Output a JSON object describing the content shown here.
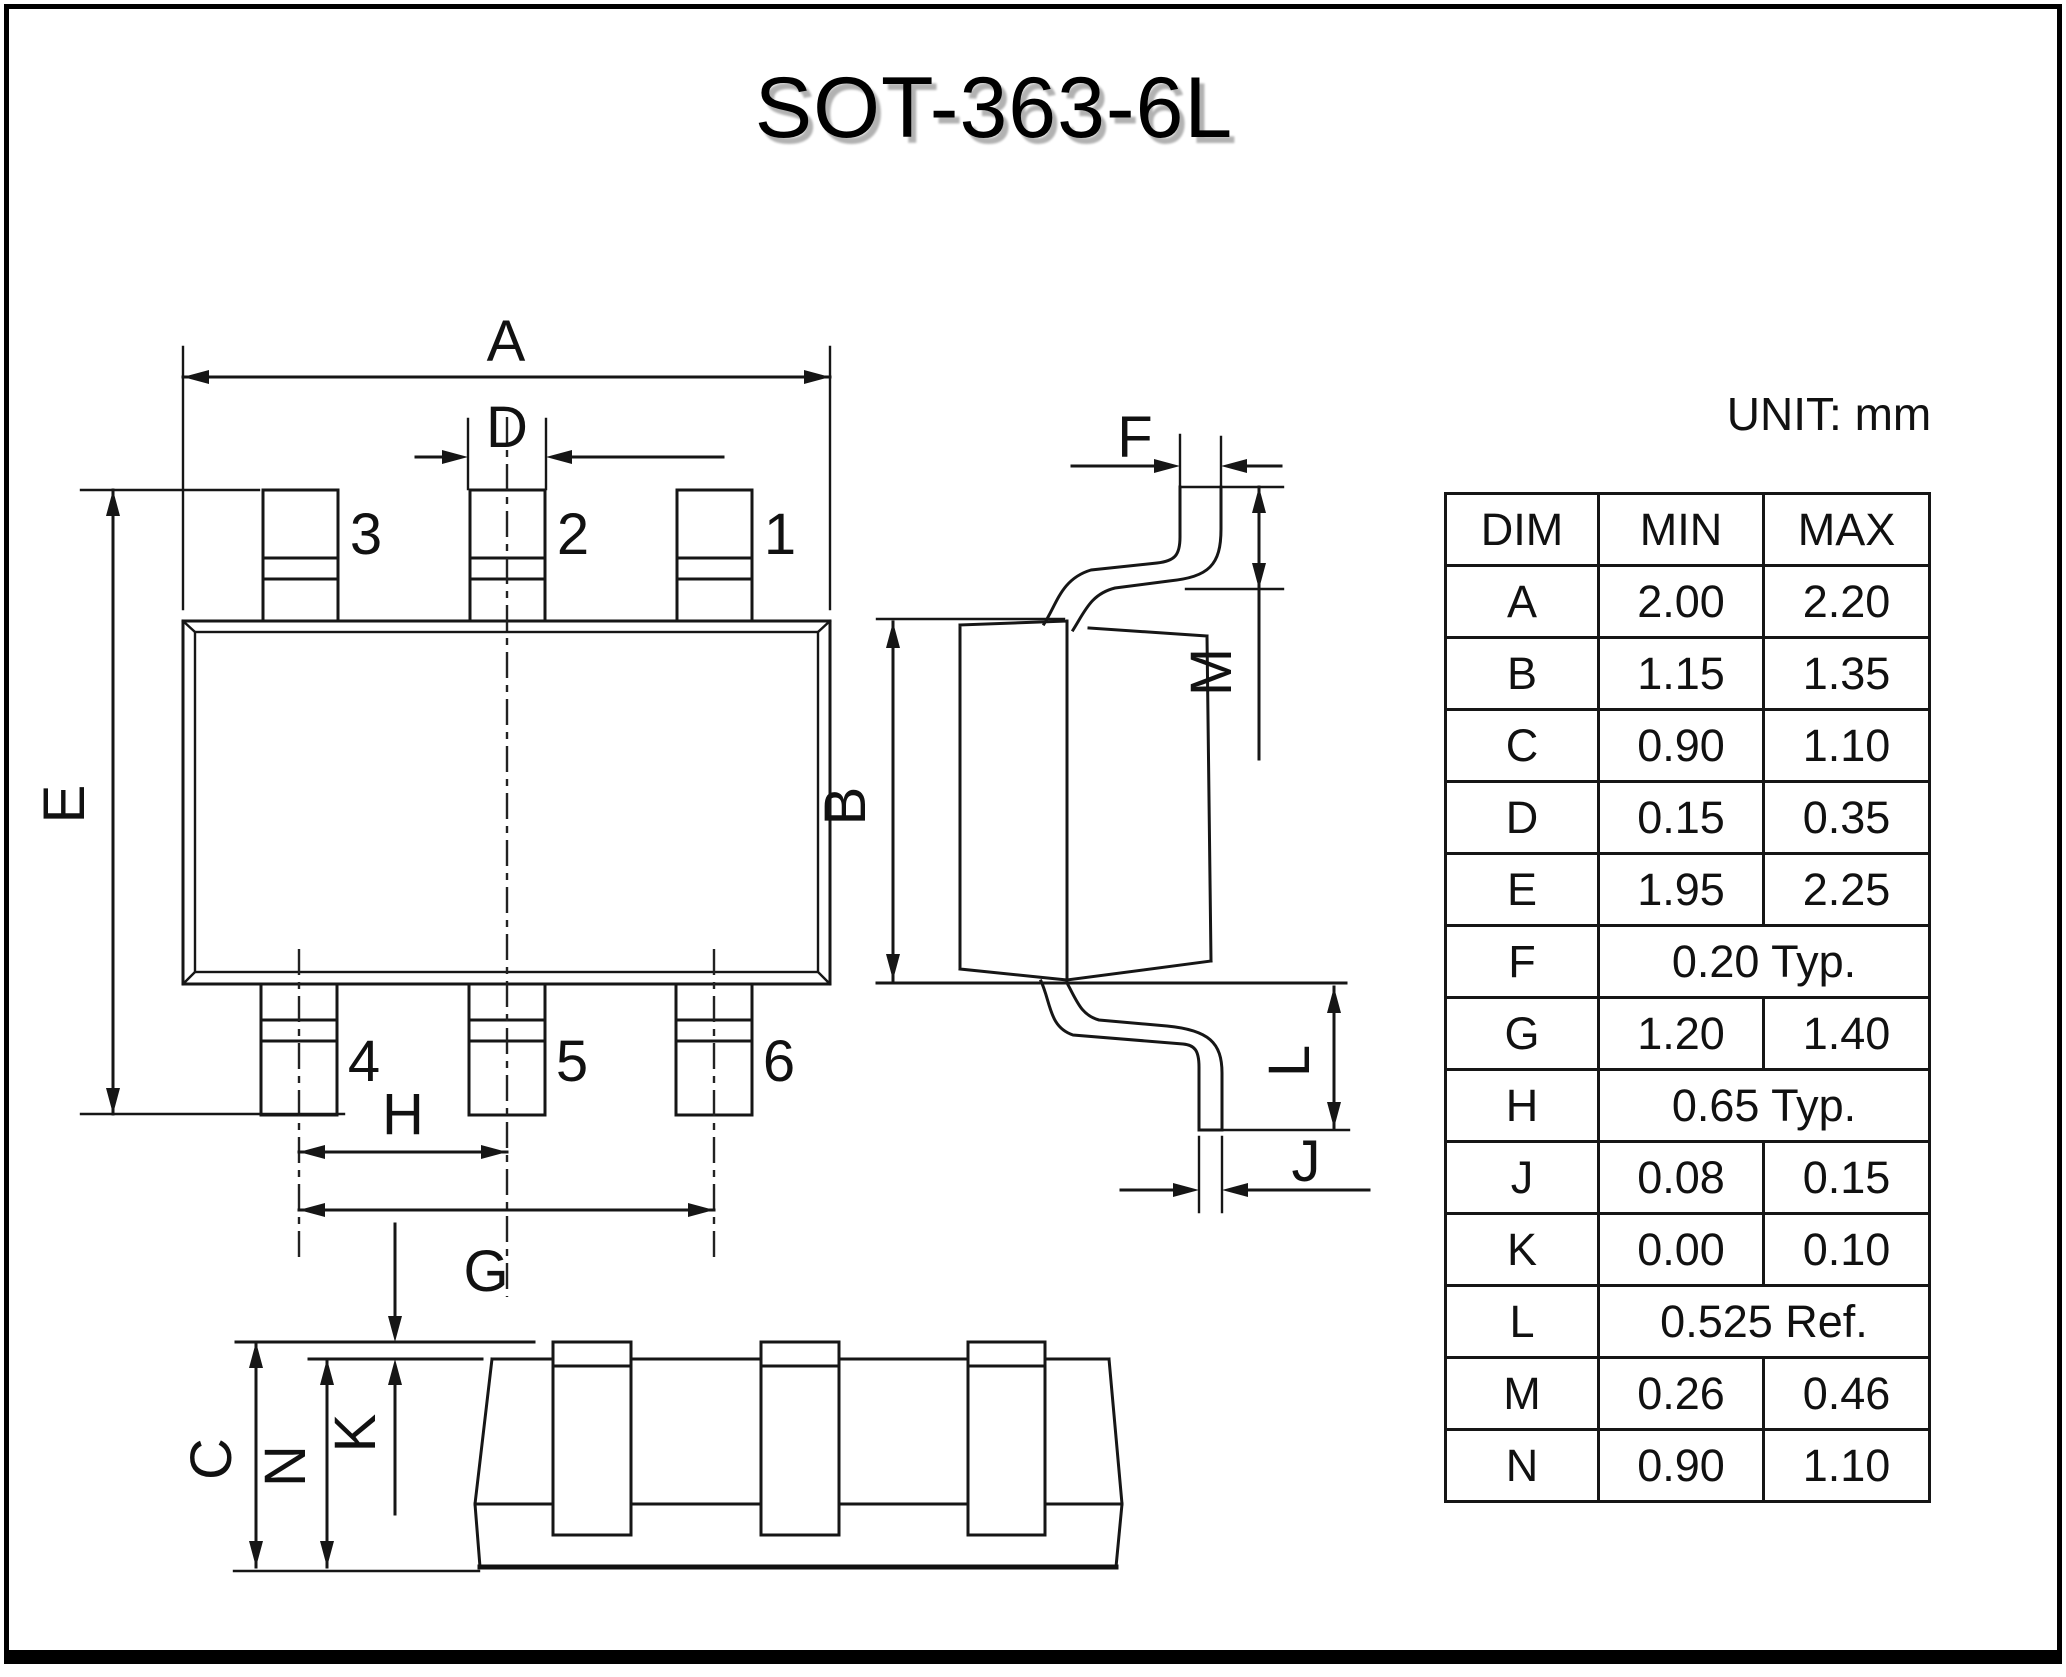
{
  "page": {
    "title": "SOT-363-6L",
    "unit_label": "UNIT: mm"
  },
  "labels": {
    "A": "A",
    "B": "B",
    "C": "C",
    "D": "D",
    "E": "E",
    "F": "F",
    "G": "G",
    "H": "H",
    "J": "J",
    "K": "K",
    "L": "L",
    "M": "M",
    "N": "N"
  },
  "pins": {
    "p1": "1",
    "p2": "2",
    "p3": "3",
    "p4": "4",
    "p5": "5",
    "p6": "6"
  },
  "table": {
    "headers": [
      "DIM",
      "MIN",
      "MAX"
    ],
    "rows": [
      {
        "dim": "A",
        "min": "2.00",
        "max": "2.20"
      },
      {
        "dim": "B",
        "min": "1.15",
        "max": "1.35"
      },
      {
        "dim": "C",
        "min": "0.90",
        "max": "1.10"
      },
      {
        "dim": "D",
        "min": "0.15",
        "max": "0.35"
      },
      {
        "dim": "E",
        "min": "1.95",
        "max": "2.25"
      },
      {
        "dim": "F",
        "span": "0.20 Typ."
      },
      {
        "dim": "G",
        "min": "1.20",
        "max": "1.40"
      },
      {
        "dim": "H",
        "span": "0.65 Typ."
      },
      {
        "dim": "J",
        "min": "0.08",
        "max": "0.15"
      },
      {
        "dim": "K",
        "min": "0.00",
        "max": "0.10"
      },
      {
        "dim": "L",
        "span": "0.525 Ref."
      },
      {
        "dim": "M",
        "min": "0.26",
        "max": "0.46"
      },
      {
        "dim": "N",
        "min": "0.90",
        "max": "1.10"
      }
    ]
  }
}
